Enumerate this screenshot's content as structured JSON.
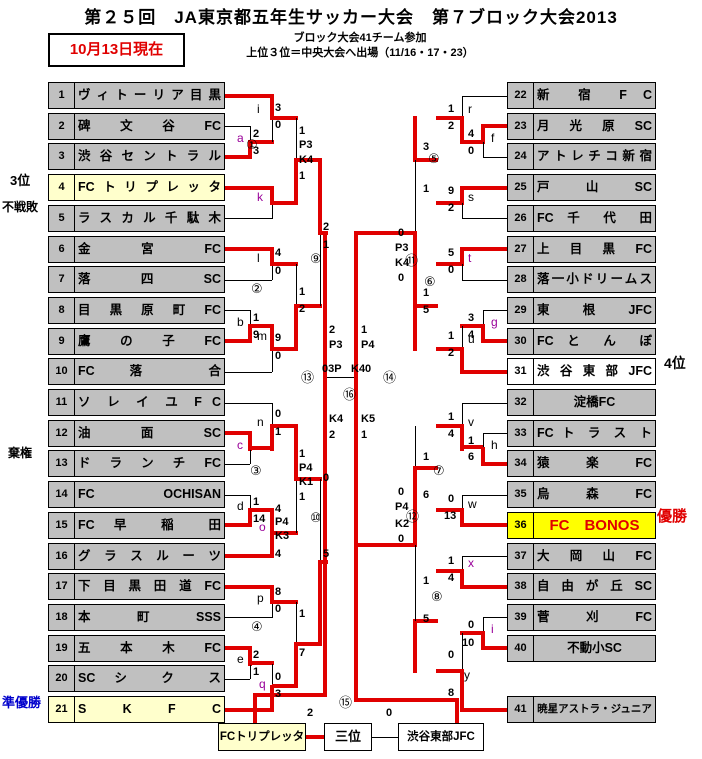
{
  "header": {
    "title": "第２５回　JA東京都五年生サッカー大会　第７ブロック大会2013",
    "updated": "10月13日現在",
    "note_line1": "ブロック大会41チーム参加",
    "note_line2": "上位３位＝中央大会へ出場（11/16・17・23）"
  },
  "colors": {
    "red": "#e00000",
    "bright_yellow": "#ffff00",
    "pale_yellow": "#ffffcc",
    "gray": "#c0c0c0",
    "blue": "#0000cc",
    "purple": "#990099",
    "black": "#000000"
  },
  "teams": [
    {
      "no": "1",
      "slot": 1,
      "side": "L",
      "name": "ヴィトーリア目黒"
    },
    {
      "no": "2",
      "slot": 2,
      "side": "L",
      "name": "碑 文 谷 FC"
    },
    {
      "no": "3",
      "slot": 3,
      "side": "L",
      "name": "渋谷セントラル"
    },
    {
      "no": "4",
      "slot": 4,
      "side": "L",
      "name": "FCトリプレッタ",
      "bg": "pale"
    },
    {
      "no": "5",
      "slot": 5,
      "side": "L",
      "name": "ラスカル千駄木"
    },
    {
      "no": "6",
      "slot": 6,
      "side": "L",
      "name": "金 宮 FC"
    },
    {
      "no": "7",
      "slot": 7,
      "side": "L",
      "name": "落 四 SC"
    },
    {
      "no": "8",
      "slot": 8,
      "side": "L",
      "name": "目 黒 原 町 FC"
    },
    {
      "no": "9",
      "slot": 9,
      "side": "L",
      "name": "鷹 の 子 FC"
    },
    {
      "no": "10",
      "slot": 10,
      "side": "L",
      "name": "FC 落 合"
    },
    {
      "no": "11",
      "slot": 11,
      "side": "L",
      "name": "ソ レ イ ユ F C"
    },
    {
      "no": "12",
      "slot": 12,
      "side": "L",
      "name": "油 面 SC"
    },
    {
      "no": "13",
      "slot": 13,
      "side": "L",
      "name": "ド ラ ン チ FC"
    },
    {
      "no": "14",
      "slot": 14,
      "side": "L",
      "name": "FC OCHISAN"
    },
    {
      "no": "15",
      "slot": 15,
      "side": "L",
      "name": "FC 早 稲 田"
    },
    {
      "no": "16",
      "slot": 16,
      "side": "L",
      "name": "グ ラ ス ル ー ツ"
    },
    {
      "no": "17",
      "slot": 17,
      "side": "L",
      "name": "下 目 黒 田 道 FC"
    },
    {
      "no": "18",
      "slot": 18,
      "side": "L",
      "name": "本 町 SSS"
    },
    {
      "no": "19",
      "slot": 19,
      "side": "L",
      "name": "五 本 木 FC"
    },
    {
      "no": "20",
      "slot": 20,
      "side": "L",
      "name": "SC シ ク ス"
    },
    {
      "no": "21",
      "slot": 21,
      "side": "L",
      "name": "S K F C",
      "bg": "pale"
    },
    {
      "no": "22",
      "slot": 1,
      "side": "R",
      "name": "新 宿 F C"
    },
    {
      "no": "23",
      "slot": 2,
      "side": "R",
      "name": "月 光 原 SC"
    },
    {
      "no": "24",
      "slot": 3,
      "side": "R",
      "name": "アトレチコ新宿"
    },
    {
      "no": "25",
      "slot": 4,
      "side": "R",
      "name": "戸 山 SC"
    },
    {
      "no": "26",
      "slot": 5,
      "side": "R",
      "name": "FC 千 代 田"
    },
    {
      "no": "27",
      "slot": 6,
      "side": "R",
      "name": "上 目 黒 FC"
    },
    {
      "no": "28",
      "slot": 7,
      "side": "R",
      "name": "落一小ドリームス"
    },
    {
      "no": "29",
      "slot": 8,
      "side": "R",
      "name": "東 根 JFC"
    },
    {
      "no": "30",
      "slot": 9,
      "side": "R",
      "name": "FC と ん ぼ"
    },
    {
      "no": "31",
      "slot": 10,
      "side": "R",
      "name": "渋 谷 東 部 JFC",
      "bg": "white"
    },
    {
      "no": "32",
      "slot": 11,
      "side": "R",
      "name": "淀橋FC",
      "align": "c"
    },
    {
      "no": "33",
      "slot": 12,
      "side": "R",
      "name": "FC ト ラ ス ト"
    },
    {
      "no": "34",
      "slot": 13,
      "side": "R",
      "name": "猿 楽 FC"
    },
    {
      "no": "35",
      "slot": 14,
      "side": "R",
      "name": "烏 森 FC"
    },
    {
      "no": "36",
      "slot": 15,
      "side": "R",
      "name": "FC　BONOS",
      "bg": "bright",
      "fg": "red",
      "align": "c",
      "fs": 15
    },
    {
      "no": "37",
      "slot": 16,
      "side": "R",
      "name": "大 岡 山 FC"
    },
    {
      "no": "38",
      "slot": 17,
      "side": "R",
      "name": "自 由 が 丘 SC"
    },
    {
      "no": "39",
      "slot": 18,
      "side": "R",
      "name": "菅 刈 FC"
    },
    {
      "no": "40",
      "slot": 19,
      "side": "R",
      "name": "不動小SC",
      "align": "c"
    },
    {
      "no": "41",
      "slot": 21,
      "side": "R",
      "name": "暁星アストラ・ジュニア",
      "align": "c",
      "fs": 10.5
    }
  ],
  "side_labels": [
    {
      "text": "3位",
      "x": 10,
      "y": 174,
      "fs": 13,
      "color": "black"
    },
    {
      "text": "不戦敗",
      "x": 2,
      "y": 201,
      "fs": 12,
      "color": "black"
    },
    {
      "text": "棄権",
      "x": 8,
      "y": 447,
      "fs": 12,
      "color": "black"
    },
    {
      "text": "準優勝",
      "x": 2,
      "y": 696,
      "fs": 13,
      "color": "blue"
    },
    {
      "text": "4位",
      "x": 664,
      "y": 356,
      "fs": 14,
      "color": "black"
    },
    {
      "text": "優勝",
      "x": 657,
      "y": 509,
      "fs": 15,
      "color": "red"
    }
  ],
  "annotations": [
    {
      "k": "s",
      "t": "2",
      "x": 253,
      "y": 129
    },
    {
      "k": "s",
      "t": "3",
      "x": 253,
      "y": 146
    },
    {
      "k": "s",
      "t": "1",
      "x": 253,
      "y": 313
    },
    {
      "k": "s",
      "t": "9",
      "x": 253,
      "y": 330
    },
    {
      "k": "s",
      "t": "1",
      "x": 253,
      "y": 497
    },
    {
      "k": "s",
      "t": "14",
      "x": 253,
      "y": 514
    },
    {
      "k": "s",
      "t": "2",
      "x": 253,
      "y": 650
    },
    {
      "k": "s",
      "t": "1",
      "x": 253,
      "y": 667
    },
    {
      "k": "s",
      "t": "4",
      "x": 468,
      "y": 129
    },
    {
      "k": "s",
      "t": "0",
      "x": 468,
      "y": 146
    },
    {
      "k": "s",
      "t": "3",
      "x": 468,
      "y": 313
    },
    {
      "k": "s",
      "t": "4",
      "x": 468,
      "y": 330
    },
    {
      "k": "s",
      "t": "1",
      "x": 468,
      "y": 436
    },
    {
      "k": "s",
      "t": "6",
      "x": 468,
      "y": 452
    },
    {
      "k": "s",
      "t": "0",
      "x": 468,
      "y": 620
    },
    {
      "k": "s",
      "t": "10",
      "x": 462,
      "y": 638
    },
    {
      "k": "s",
      "t": "3",
      "x": 275,
      "y": 103
    },
    {
      "k": "s",
      "t": "0",
      "x": 275,
      "y": 120
    },
    {
      "k": "s",
      "t": "4",
      "x": 275,
      "y": 248
    },
    {
      "k": "s",
      "t": "0",
      "x": 275,
      "y": 266
    },
    {
      "k": "s",
      "t": "9",
      "x": 275,
      "y": 333
    },
    {
      "k": "s",
      "t": "0",
      "x": 275,
      "y": 351
    },
    {
      "k": "s",
      "t": "0",
      "x": 275,
      "y": 409
    },
    {
      "k": "s",
      "t": "1",
      "x": 275,
      "y": 427
    },
    {
      "k": "s",
      "t": "4",
      "x": 275,
      "y": 504
    },
    {
      "k": "s",
      "t": "P4",
      "x": 275,
      "y": 517
    },
    {
      "k": "s",
      "t": "K3",
      "x": 275,
      "y": 531
    },
    {
      "k": "s",
      "t": "4",
      "x": 275,
      "y": 549
    },
    {
      "k": "s",
      "t": "8",
      "x": 275,
      "y": 587
    },
    {
      "k": "s",
      "t": "0",
      "x": 275,
      "y": 604
    },
    {
      "k": "s",
      "t": "0",
      "x": 275,
      "y": 672
    },
    {
      "k": "s",
      "t": "3",
      "x": 275,
      "y": 689
    },
    {
      "k": "s",
      "t": "1",
      "x": 448,
      "y": 104
    },
    {
      "k": "s",
      "t": "2",
      "x": 448,
      "y": 121
    },
    {
      "k": "s",
      "t": "9",
      "x": 448,
      "y": 186
    },
    {
      "k": "s",
      "t": "2",
      "x": 448,
      "y": 203
    },
    {
      "k": "s",
      "t": "5",
      "x": 448,
      "y": 248
    },
    {
      "k": "s",
      "t": "0",
      "x": 448,
      "y": 265
    },
    {
      "k": "s",
      "t": "1",
      "x": 448,
      "y": 331
    },
    {
      "k": "s",
      "t": "2",
      "x": 448,
      "y": 348
    },
    {
      "k": "s",
      "t": "1",
      "x": 448,
      "y": 412
    },
    {
      "k": "s",
      "t": "4",
      "x": 448,
      "y": 429
    },
    {
      "k": "s",
      "t": "0",
      "x": 448,
      "y": 494
    },
    {
      "k": "s",
      "t": "13",
      "x": 444,
      "y": 511
    },
    {
      "k": "s",
      "t": "1",
      "x": 448,
      "y": 556
    },
    {
      "k": "s",
      "t": "4",
      "x": 448,
      "y": 573
    },
    {
      "k": "s",
      "t": "0",
      "x": 448,
      "y": 650
    },
    {
      "k": "s",
      "t": "8",
      "x": 448,
      "y": 688
    },
    {
      "k": "s",
      "t": "1",
      "x": 299,
      "y": 126
    },
    {
      "k": "s",
      "t": "P3",
      "x": 299,
      "y": 140
    },
    {
      "k": "s",
      "t": "K4",
      "x": 299,
      "y": 155
    },
    {
      "k": "s",
      "t": "1",
      "x": 299,
      "y": 171
    },
    {
      "k": "s",
      "t": "1",
      "x": 299,
      "y": 287
    },
    {
      "k": "s",
      "t": "2",
      "x": 299,
      "y": 304
    },
    {
      "k": "s",
      "t": "1",
      "x": 299,
      "y": 449
    },
    {
      "k": "s",
      "t": "P4",
      "x": 299,
      "y": 463
    },
    {
      "k": "s",
      "t": "K1",
      "x": 299,
      "y": 477
    },
    {
      "k": "s",
      "t": "1",
      "x": 299,
      "y": 492
    },
    {
      "k": "s",
      "t": "1",
      "x": 299,
      "y": 609
    },
    {
      "k": "s",
      "t": "7",
      "x": 299,
      "y": 648
    },
    {
      "k": "s",
      "t": "3",
      "x": 423,
      "y": 142
    },
    {
      "k": "s",
      "t": "1",
      "x": 423,
      "y": 184
    },
    {
      "k": "s",
      "t": "1",
      "x": 423,
      "y": 288
    },
    {
      "k": "s",
      "t": "5",
      "x": 423,
      "y": 305
    },
    {
      "k": "s",
      "t": "1",
      "x": 423,
      "y": 452
    },
    {
      "k": "s",
      "t": "6",
      "x": 423,
      "y": 490
    },
    {
      "k": "s",
      "t": "1",
      "x": 423,
      "y": 576
    },
    {
      "k": "s",
      "t": "5",
      "x": 423,
      "y": 614
    },
    {
      "k": "s",
      "t": "2",
      "x": 323,
      "y": 222
    },
    {
      "k": "s",
      "t": "1",
      "x": 323,
      "y": 240
    },
    {
      "k": "s",
      "t": "0",
      "x": 323,
      "y": 473
    },
    {
      "k": "s",
      "t": "5",
      "x": 323,
      "y": 549
    },
    {
      "k": "s",
      "t": "0",
      "x": 398,
      "y": 228
    },
    {
      "k": "s",
      "t": "P3",
      "x": 395,
      "y": 243
    },
    {
      "k": "s",
      "t": "K4",
      "x": 395,
      "y": 258
    },
    {
      "k": "s",
      "t": "0",
      "x": 398,
      "y": 273
    },
    {
      "k": "s",
      "t": "0",
      "x": 398,
      "y": 487
    },
    {
      "k": "s",
      "t": "P4",
      "x": 395,
      "y": 502
    },
    {
      "k": "s",
      "t": "K2",
      "x": 395,
      "y": 519
    },
    {
      "k": "s",
      "t": "0",
      "x": 398,
      "y": 534
    },
    {
      "k": "s",
      "t": "2",
      "x": 329,
      "y": 325
    },
    {
      "k": "s",
      "t": "P3",
      "x": 329,
      "y": 340
    },
    {
      "k": "s",
      "t": "K4",
      "x": 329,
      "y": 414
    },
    {
      "k": "s",
      "t": "2",
      "x": 329,
      "y": 430
    },
    {
      "k": "s",
      "t": "1",
      "x": 361,
      "y": 325
    },
    {
      "k": "s",
      "t": "P4",
      "x": 361,
      "y": 340
    },
    {
      "k": "s",
      "t": "K5",
      "x": 361,
      "y": 414
    },
    {
      "k": "s",
      "t": "1",
      "x": 361,
      "y": 430
    },
    {
      "k": "s",
      "t": "03P",
      "x": 322,
      "y": 364
    },
    {
      "k": "s",
      "t": "K40",
      "x": 351,
      "y": 364
    },
    {
      "k": "s",
      "t": "2",
      "x": 307,
      "y": 708
    },
    {
      "k": "s",
      "t": "0",
      "x": 386,
      "y": 708
    },
    {
      "k": "l",
      "t": "a",
      "x": 237,
      "y": 132,
      "c": "purple"
    },
    {
      "k": "l",
      "t": "b",
      "x": 237,
      "y": 316
    },
    {
      "k": "l",
      "t": "c",
      "x": 237,
      "y": 439,
      "c": "purple"
    },
    {
      "k": "l",
      "t": "d",
      "x": 237,
      "y": 500
    },
    {
      "k": "l",
      "t": "e",
      "x": 237,
      "y": 653
    },
    {
      "k": "l",
      "t": "f",
      "x": 491,
      "y": 132
    },
    {
      "k": "l",
      "t": "g",
      "x": 491,
      "y": 316,
      "c": "purple"
    },
    {
      "k": "l",
      "t": "h",
      "x": 491,
      "y": 439
    },
    {
      "k": "l",
      "t": "i",
      "x": 491,
      "y": 623,
      "c": "purple"
    },
    {
      "k": "l",
      "t": "i",
      "x": 257,
      "y": 103
    },
    {
      "k": "l",
      "t": "k",
      "x": 257,
      "y": 191,
      "c": "purple"
    },
    {
      "k": "l",
      "t": "l",
      "x": 257,
      "y": 252
    },
    {
      "k": "l",
      "t": "m",
      "x": 257,
      "y": 330
    },
    {
      "k": "l",
      "t": "n",
      "x": 257,
      "y": 416
    },
    {
      "k": "l",
      "t": "o",
      "x": 259,
      "y": 521,
      "c": "purple"
    },
    {
      "k": "l",
      "t": "p",
      "x": 257,
      "y": 592
    },
    {
      "k": "l",
      "t": "q",
      "x": 259,
      "y": 678,
      "c": "purple"
    },
    {
      "k": "l",
      "t": "r",
      "x": 468,
      "y": 103
    },
    {
      "k": "l",
      "t": "s",
      "x": 468,
      "y": 191
    },
    {
      "k": "l",
      "t": "t",
      "x": 468,
      "y": 252,
      "c": "purple"
    },
    {
      "k": "l",
      "t": "u",
      "x": 468,
      "y": 333
    },
    {
      "k": "l",
      "t": "v",
      "x": 468,
      "y": 416
    },
    {
      "k": "l",
      "t": "w",
      "x": 468,
      "y": 498
    },
    {
      "k": "l",
      "t": "x",
      "x": 468,
      "y": 557,
      "c": "purple"
    },
    {
      "k": "l",
      "t": "y",
      "x": 464,
      "y": 669
    },
    {
      "k": "c",
      "t": "①",
      "x": 246,
      "y": 138
    },
    {
      "k": "c",
      "t": "②",
      "x": 251,
      "y": 282
    },
    {
      "k": "c",
      "t": "③",
      "x": 250,
      "y": 464
    },
    {
      "k": "c",
      "t": "④",
      "x": 251,
      "y": 620
    },
    {
      "k": "c",
      "t": "⑤",
      "x": 428,
      "y": 152
    },
    {
      "k": "c",
      "t": "⑥",
      "x": 424,
      "y": 275
    },
    {
      "k": "c",
      "t": "⑦",
      "x": 433,
      "y": 464
    },
    {
      "k": "c",
      "t": "⑧",
      "x": 431,
      "y": 590
    },
    {
      "k": "c",
      "t": "⑨",
      "x": 310,
      "y": 252
    },
    {
      "k": "c",
      "t": "⑩",
      "x": 310,
      "y": 511
    },
    {
      "k": "c",
      "t": "⑪",
      "x": 405,
      "y": 254
    },
    {
      "k": "c",
      "t": "⑫",
      "x": 406,
      "y": 510
    },
    {
      "k": "c",
      "t": "⑬",
      "x": 301,
      "y": 371
    },
    {
      "k": "c",
      "t": "⑭",
      "x": 383,
      "y": 371
    },
    {
      "k": "c",
      "t": "⑮",
      "x": 339,
      "y": 696
    },
    {
      "k": "c",
      "t": "⑯",
      "x": 343,
      "y": 388
    }
  ],
  "third_place": {
    "left_team": "FCトリプレッタ",
    "label": "三位",
    "right_team": "渋谷東部JFC"
  }
}
